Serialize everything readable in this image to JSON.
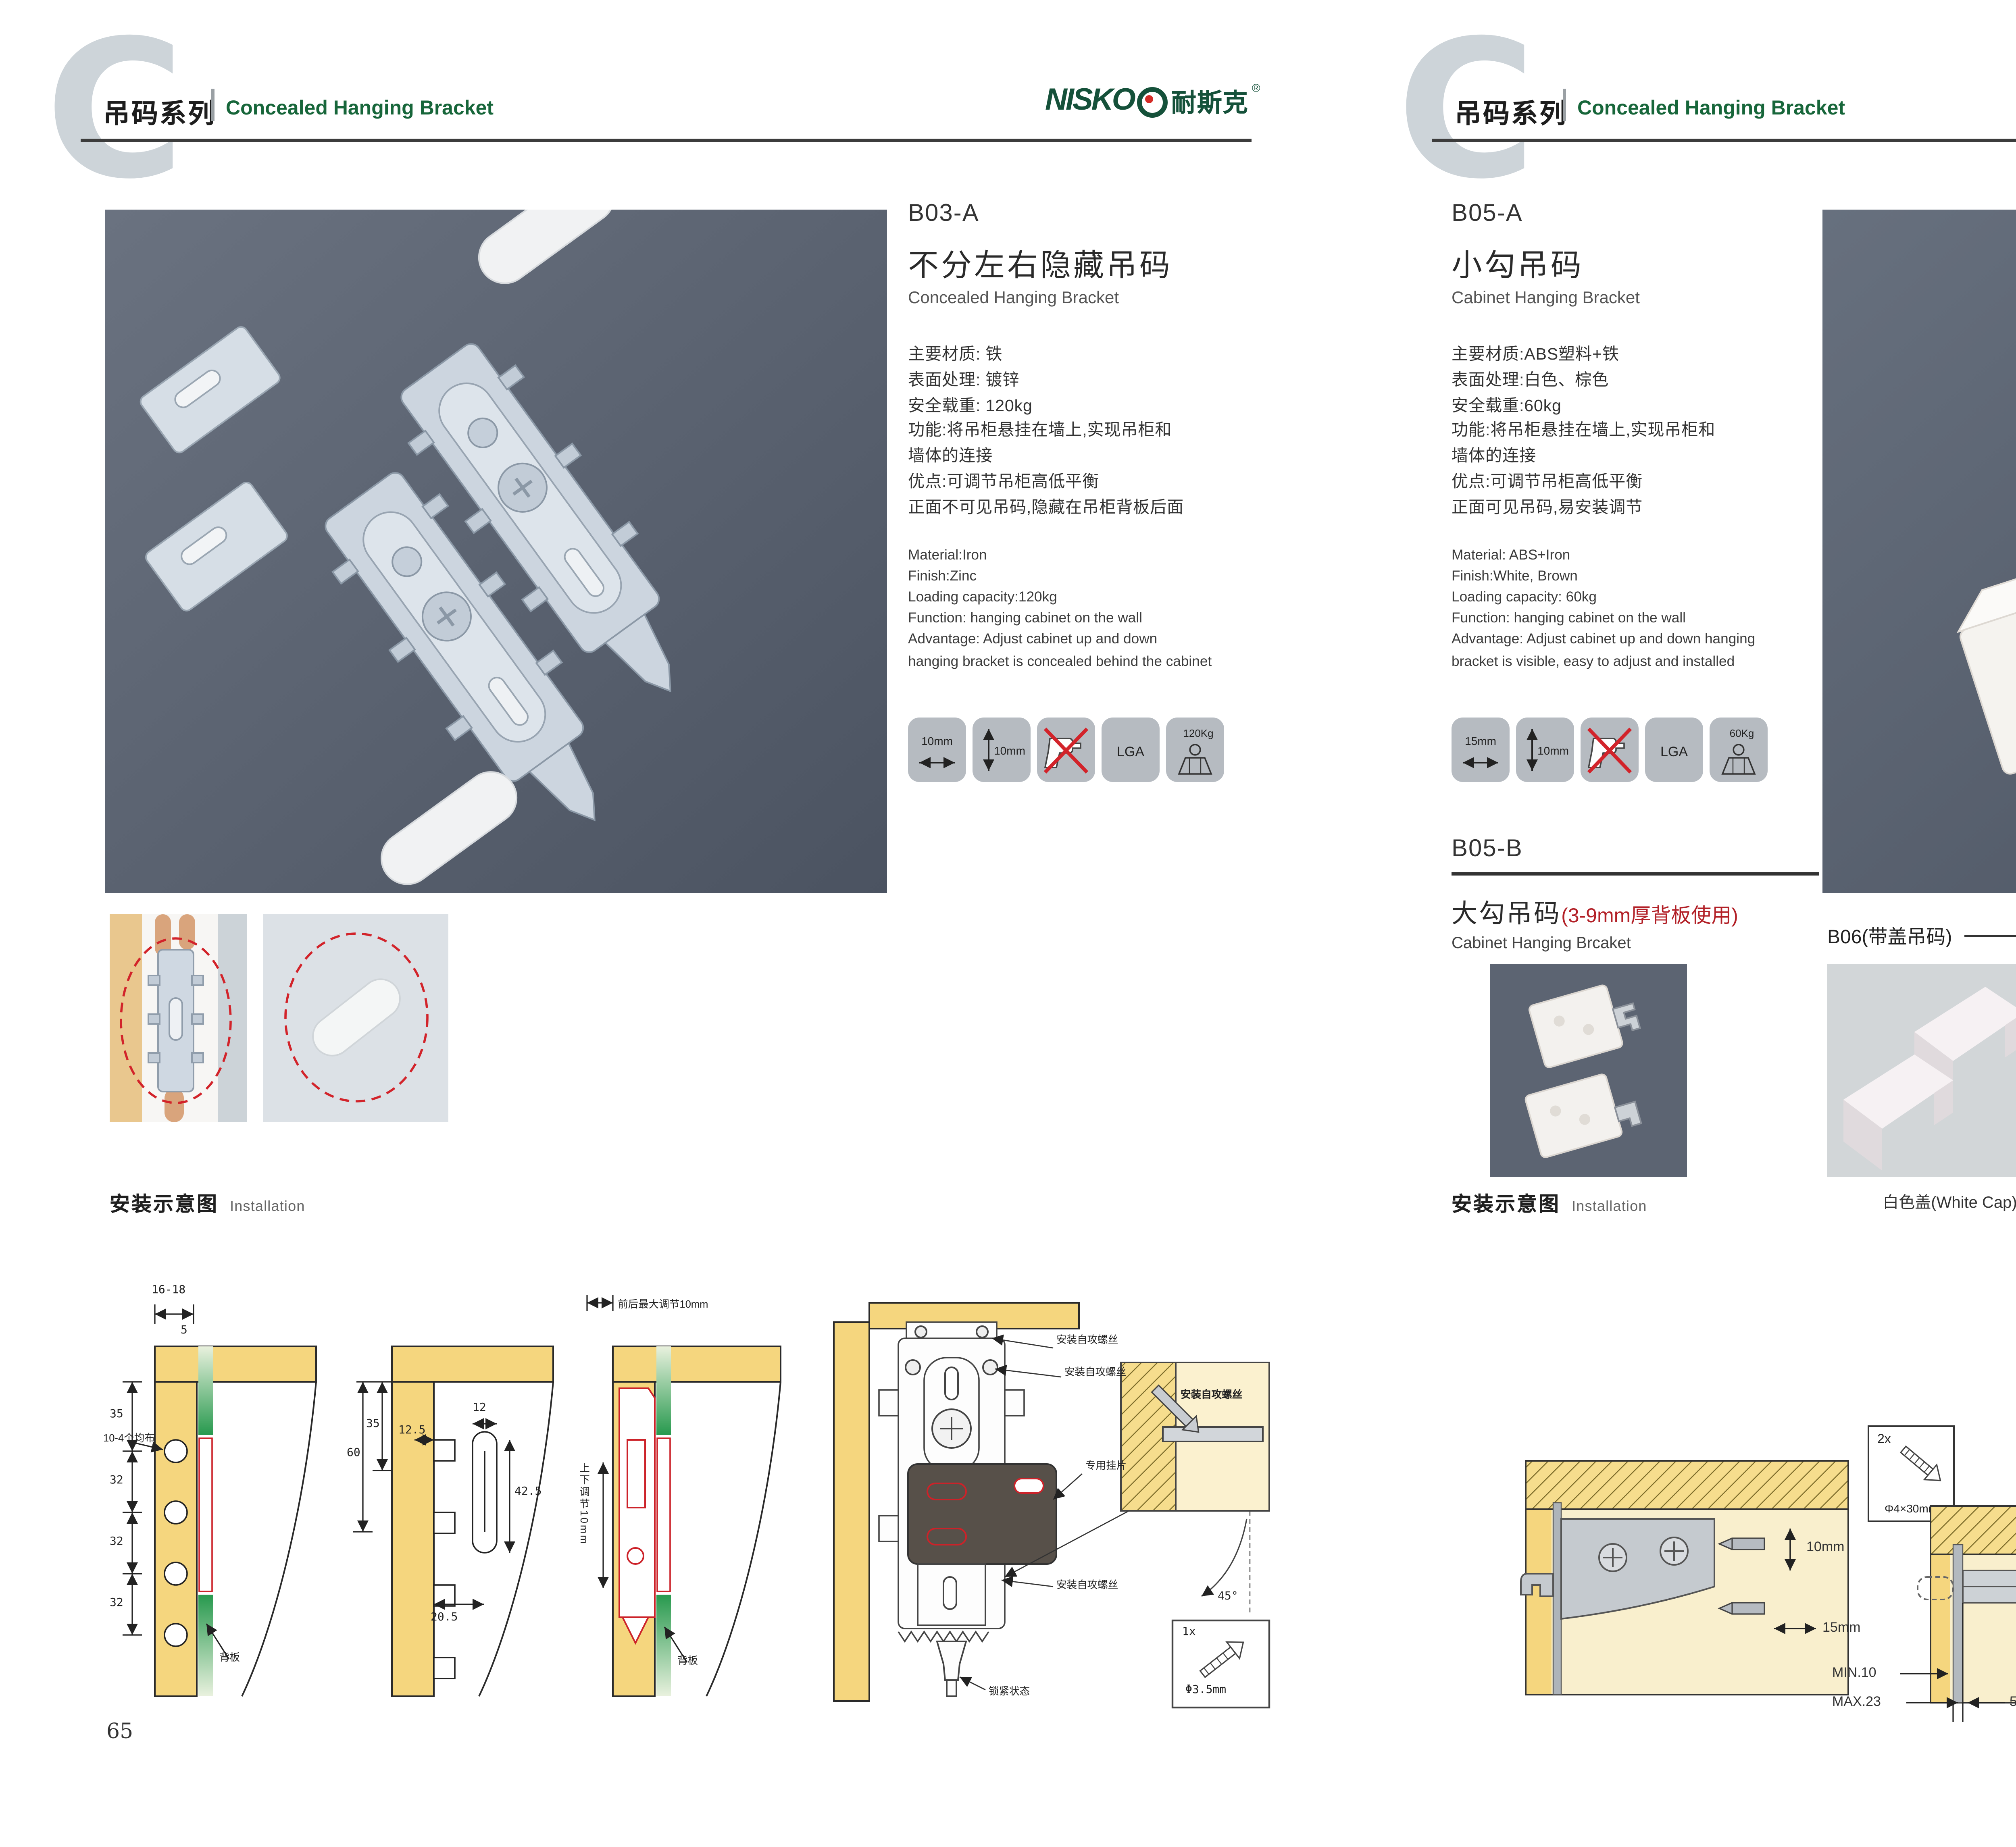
{
  "header": {
    "series_zh": "吊码系列",
    "series_en": "Concealed Hanging Bracket",
    "logo_nisko": "NISKO",
    "logo_zh": "耐斯克",
    "logo_reg": "®"
  },
  "colors": {
    "accent_green": "#17663a",
    "logo_green": "#15513a",
    "warning_red": "#b21f26",
    "photo_slate": "#59616f",
    "wood_yellow": "#f5d67e",
    "icon_gray": "#b6bbc1"
  },
  "left": {
    "page_number": "65",
    "code": "B03-A",
    "title_zh": "不分左右隐藏吊码",
    "title_en": "Concealed Hanging Bracket",
    "specs_zh": [
      "主要材质: 铁",
      "表面处理: 镀锌",
      "安全载重: 120kg",
      "功能:将吊柜悬挂在墙上,实现吊柜和",
      "墙体的连接",
      "优点:可调节吊柜高低平衡",
      "正面不可见吊码,隐藏在吊柜背板后面"
    ],
    "specs_en": [
      "Material:Iron",
      "Finish:Zinc",
      "Loading capacity:120kg",
      "Function: hanging cabinet on the wall",
      "Advantage: Adjust cabinet up and down",
      "hanging bracket is concealed behind the cabinet"
    ],
    "icons": {
      "width": "10mm",
      "height": "10mm",
      "lga": "LGA",
      "load": "120Kg"
    },
    "install": {
      "heading_zh": "安装示意图",
      "heading_en": "Installation",
      "d1": {
        "top": "16-18",
        "offset": "5",
        "v1": "35",
        "v2": "32",
        "v3": "32",
        "v4": "32",
        "holes": "10-4个均布",
        "backboard": "背板"
      },
      "d2": {
        "h1": "60",
        "h2": "35",
        "w1": "12.5",
        "w2": "12",
        "slot": "42.5",
        "bottom": "20.5"
      },
      "d3": {
        "top": "前后最大调节10mm",
        "vertical": "上下调节10mm",
        "backboard": "背板"
      },
      "d4": {
        "screw1": "安装自攻螺丝",
        "screw2": "安装自攻螺丝",
        "plate": "专用挂片",
        "screw3": "安装自攻螺丝",
        "lock": "锁紧状态",
        "inset_label": "安装自攻螺丝",
        "angle": "45°",
        "qty": "1x",
        "dia": "Φ3.5mm"
      }
    }
  },
  "right": {
    "page_number": "66",
    "b05a": {
      "code": "B05-A",
      "title_zh": "小勾吊码",
      "title_en": "Cabinet Hanging Bracket",
      "specs_zh": [
        "主要材质:ABS塑料+铁",
        "表面处理:白色、棕色",
        "安全载重:60kg",
        "功能:将吊柜悬挂在墙上,实现吊柜和",
        "墙体的连接",
        "优点:可调节吊柜高低平衡",
        "正面可见吊码,易安装调节"
      ],
      "specs_en": [
        "Material: ABS+Iron",
        "Finish:White, Brown",
        "Loading capacity: 60kg",
        "Function: hanging cabinet on the wall",
        "Advantage: Adjust cabinet up and down hanging",
        "bracket is visible, easy to adjust and installed"
      ],
      "icons": {
        "width": "15mm",
        "height": "10mm",
        "lga": "LGA",
        "load": "60Kg"
      }
    },
    "b05b": {
      "code": "B05-B",
      "title_zh": "大勾吊码",
      "title_note": "(3-9mm厚背板使用)",
      "title_en": "Cabinet Hanging Brcaket"
    },
    "b06": {
      "heading": "B06(带盖吊码)",
      "caps": [
        "白色盖(White Cap)",
        "灰色盖(Gray Cap)",
        "银色盖(Silver Cap)"
      ]
    },
    "install": {
      "heading_zh": "安装示意图",
      "heading_en": "Installation",
      "d1": {
        "updown": "10mm",
        "inout": "15mm"
      },
      "screwbox": {
        "qty": "2x",
        "dia": "Φ4×30mm"
      },
      "d2": {
        "thick": "18",
        "min": "MIN.10",
        "max": "MAX.23",
        "len": "58"
      },
      "d3": {
        "t16": "16",
        "t42": "42",
        "rmax": "RMAX4",
        "b16": "16",
        "b17": "17",
        "b32": "32"
      }
    }
  }
}
